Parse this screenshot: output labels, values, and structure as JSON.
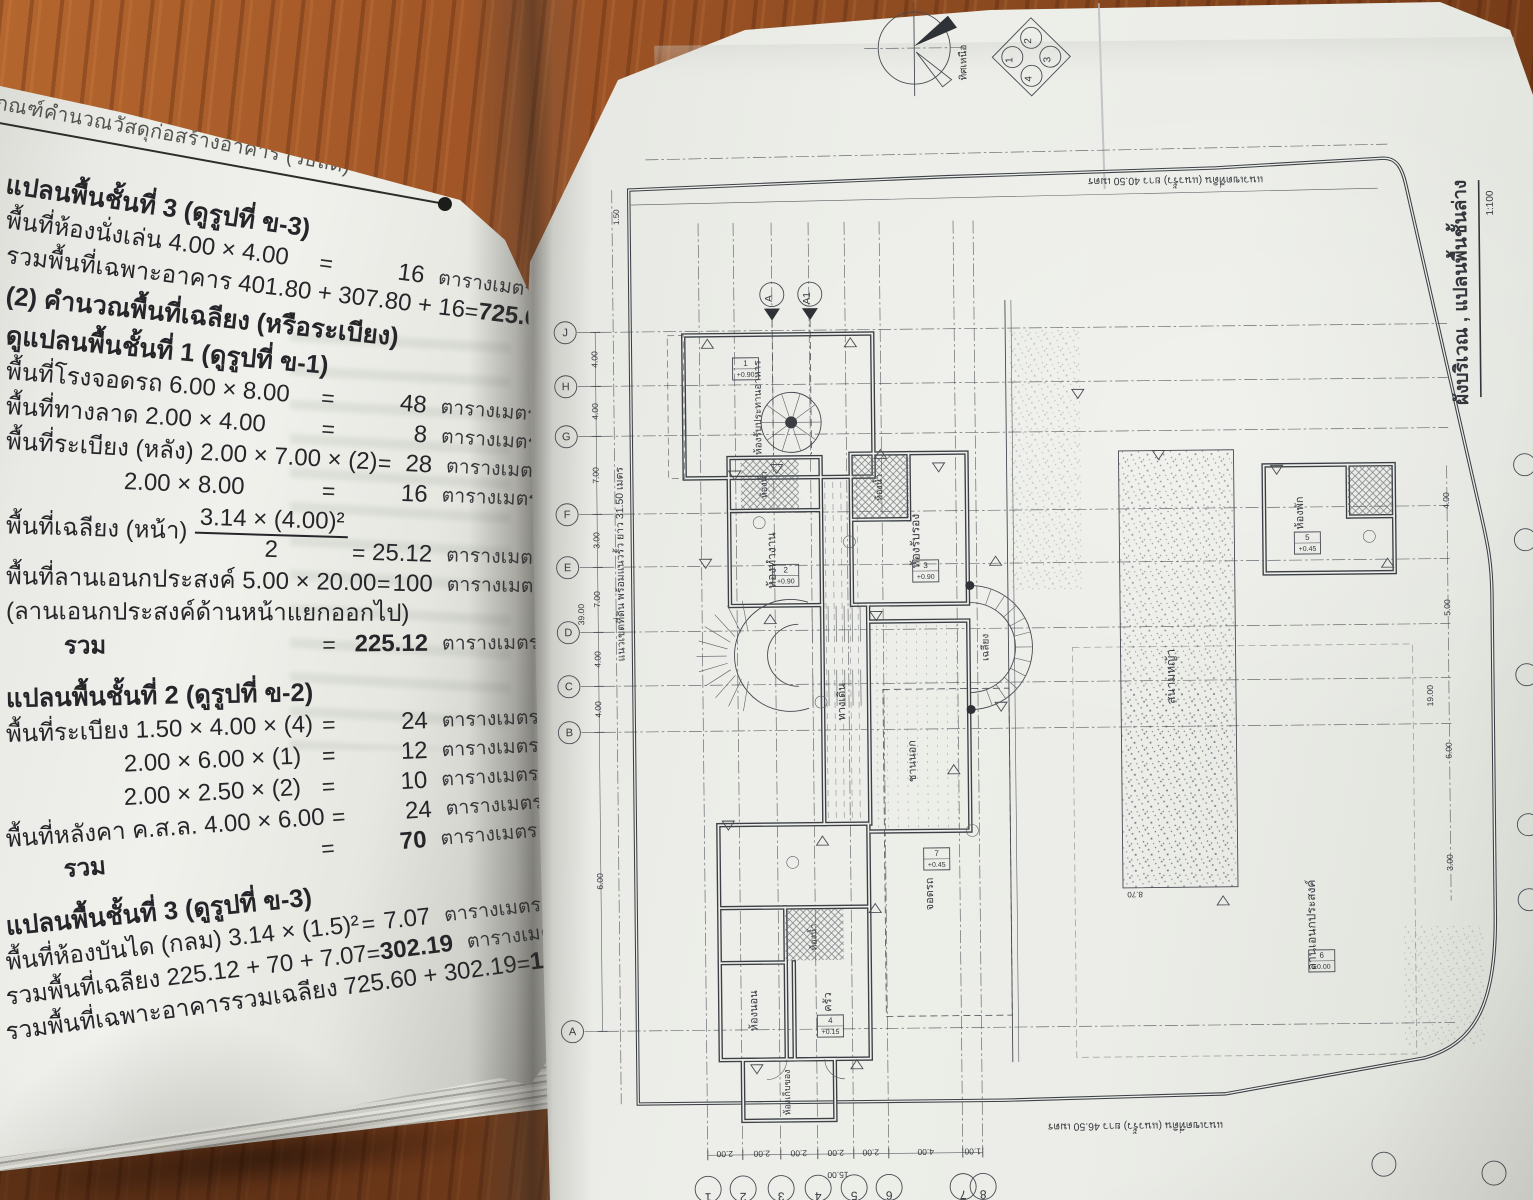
{
  "left_page": {
    "running_head": "เกณฑ์คำนวณวัสดุก่อสร้างอาคาร (วิธีลัด)",
    "equals": "=",
    "rows": [
      {
        "type": "h1",
        "label": "แปลนพื้นชั้นที่ 3 (ดูรูปที่ ข-3)"
      },
      {
        "label": "พื้นที่ห้องนั่งเล่น 4.00 × 4.00",
        "value": "16",
        "unit": "ตารางเมตร"
      },
      {
        "label": "รวมพื้นที่เฉพาะอาคาร 401.80 + 307.80 + 16",
        "value": "725.60",
        "unit": "ตารางเมตร",
        "bold_value": true
      },
      {
        "type": "h1",
        "label": "(2) คำนวณพื้นที่เฉลียง (หรือระเบียง)"
      },
      {
        "type": "h1",
        "label": "ดูแปลนพื้นชั้นที่ 1 (ดูรูปที่ ข-1)"
      },
      {
        "label": "พื้นที่โรงจอดรถ 6.00 × 8.00",
        "value": "48",
        "unit": "ตารางเมตร"
      },
      {
        "label": "พื้นที่ทางลาด 2.00 × 4.00",
        "value": "8",
        "unit": "ตารางเมตร"
      },
      {
        "label": "พื้นที่ระเบียง (หลัง) 2.00 × 7.00 × (2)",
        "value": "28",
        "unit": "ตารางเมตร"
      },
      {
        "label": "2.00 × 8.00",
        "indent": 2,
        "value": "16",
        "unit": "ตารางเมตร"
      },
      {
        "type": "frac",
        "label": "พื้นที่เฉลียง (หน้า)",
        "num": "3.14 × (4.00)²",
        "den": "2",
        "value": "25.12",
        "unit": "ตารางเมตร"
      },
      {
        "label": "พื้นที่ลานเอนกประสงค์  5.00 × 20.00",
        "value": "100",
        "unit": "ตารางเมตร"
      },
      {
        "label": "(ลานเอนกประสงค์ด้านหน้าแยกออกไป)"
      },
      {
        "label": "รวม",
        "indent": 1,
        "value": "225.12",
        "unit": "ตารางเมตร",
        "bold_value": true
      },
      {
        "type": "h1",
        "gap": true,
        "label": "แปลนพื้นชั้นที่ 2  (ดูรูปที่ ข-2)"
      },
      {
        "label": "พื้นที่ระเบียง  1.50 × 4.00 × (4)",
        "value": "24",
        "unit": "ตารางเมตร"
      },
      {
        "label": "2.00 × 6.00 × (1)",
        "indent": 2,
        "value": "12",
        "unit": "ตารางเมตร"
      },
      {
        "label": "2.00 × 2.50 × (2)",
        "indent": 2,
        "value": "10",
        "unit": "ตารางเมตร"
      },
      {
        "label": "พื้นที่หลังคา ค.ส.ล. 4.00 × 6.00",
        "value": "24",
        "unit": "ตารางเมตร"
      },
      {
        "label": "รวม",
        "indent": 1,
        "value": "70",
        "unit": "ตารางเมตร",
        "bold_value": true
      },
      {
        "type": "h1",
        "gap": true,
        "label": "แปลนพื้นชั้นที่ 3  (ดูรูปที่ ข-3)"
      },
      {
        "label": "พื้นที่ห้องบันได (กลม)  3.14 × (1.5)²",
        "value": "7.07",
        "unit": "ตารางเมตร"
      },
      {
        "label": "รวมพื้นที่เฉลียง  225.12 + 70 + 7.07",
        "value": "302.19",
        "unit": "ตารางเมตร",
        "bold_value": true
      },
      {
        "label": "รวมพื้นที่เฉพาะอาคารรวมเฉลียง 725.60 + 302.19",
        "value": "1,027.79",
        "unit": "ตารางเมตร",
        "bold_value": true
      }
    ]
  },
  "right_page": {
    "title": "ผังบริเวณ , แปลนพื้นชั้นล่าง",
    "scale": "1:100",
    "compass_label": "ทิศเหนือ",
    "boundary_top": "แนวเขตที่ดิน (แนวรั้ว) ยาว 40.50 เมตร",
    "boundary_bottom": "แนวเขตที่ดิน (แนวรั้ว) ยาว 46.50 เมตร",
    "boundary_left": "แนวเขตที่ดิน พร้อมแนวรั้ว ยาว 31.50 เมตร",
    "keyplan_numbers": [
      {
        "t": "1",
        "x": 498,
        "y": 57
      },
      {
        "t": "2",
        "x": 517,
        "y": 38
      },
      {
        "t": "3",
        "x": 536,
        "y": 57
      },
      {
        "t": "4",
        "x": 517,
        "y": 76
      }
    ],
    "section_markers": [
      {
        "t": "A",
        "x": 255,
        "y": 292
      },
      {
        "t": "A1",
        "x": 293,
        "y": 292
      }
    ],
    "grid_letters": [
      {
        "t": "J",
        "y": 328
      },
      {
        "t": "H",
        "y": 382
      },
      {
        "t": "G",
        "y": 432
      },
      {
        "t": "F",
        "y": 510
      },
      {
        "t": "E",
        "y": 563
      },
      {
        "t": "D",
        "y": 628
      },
      {
        "t": "C",
        "y": 682
      },
      {
        "t": "B",
        "y": 728
      },
      {
        "t": "A",
        "y": 1027
      }
    ],
    "grid_numbers": [
      {
        "t": "1",
        "x": 182
      },
      {
        "t": "2",
        "x": 217
      },
      {
        "t": "3",
        "x": 255
      },
      {
        "t": "4",
        "x": 292
      },
      {
        "t": "5",
        "x": 328
      },
      {
        "t": "6",
        "x": 363
      },
      {
        "t": "7",
        "x": 437
      },
      {
        "t": "8",
        "x": 457
      }
    ],
    "dims_left": [
      {
        "t": "4.00",
        "y": 355
      },
      {
        "t": "4.00",
        "y": 407
      },
      {
        "t": "7.00",
        "y": 471
      },
      {
        "t": "3.00",
        "y": 536
      },
      {
        "t": "7.00",
        "y": 595
      },
      {
        "t": "4.00",
        "y": 655
      },
      {
        "t": "4.00",
        "y": 705
      },
      {
        "t": "6.00",
        "y": 877
      }
    ],
    "dims_left_total": "39.00",
    "dims_bottom": [
      {
        "t": "2.00",
        "x": 199
      },
      {
        "t": "2.00",
        "x": 236
      },
      {
        "t": "2.00",
        "x": 273
      },
      {
        "t": "2.00",
        "x": 310
      },
      {
        "t": "2.00",
        "x": 345
      },
      {
        "t": "4.00",
        "x": 400
      },
      {
        "t": "1.00",
        "x": 447
      }
    ],
    "dims_bottom_total": "15.00",
    "dims_right": [
      {
        "t": "4.00",
        "y": 505
      },
      {
        "t": "5.00",
        "y": 612
      },
      {
        "t": "6.00",
        "y": 755
      },
      {
        "t": "3.00",
        "y": 867
      }
    ],
    "dims_right_total": "19.00",
    "misc_dims": [
      {
        "t": "1.50",
        "x": 103,
        "y": 213,
        "r": -90
      },
      {
        "t": "8.70",
        "x": 612,
        "y": 893,
        "r": 180
      }
    ],
    "room_labels": [
      {
        "t": "ห้องรับประทานอาหาร",
        "x": 243,
        "y": 405,
        "s": 10
      },
      {
        "t": "ห้องทำงาน",
        "x": 256,
        "y": 558,
        "s": 12
      },
      {
        "t": "ห้องรับรอง",
        "x": 400,
        "y": 540,
        "s": 12
      },
      {
        "t": "ห้องน้ำ",
        "x": 248,
        "y": 482,
        "s": 9
      },
      {
        "t": "ห้องน้ำ",
        "x": 363,
        "y": 486,
        "s": 9
      },
      {
        "t": "ทางเดิน",
        "x": 324,
        "y": 700,
        "s": 11
      },
      {
        "t": "ชานนอก",
        "x": 394,
        "y": 760,
        "s": 11
      },
      {
        "t": "เฉลียง",
        "x": 468,
        "y": 647,
        "s": 10
      },
      {
        "t": "จอดรถ",
        "x": 410,
        "y": 893,
        "s": 11
      },
      {
        "t": "ห้องน้ำ",
        "x": 293,
        "y": 935,
        "s": 9
      },
      {
        "t": "ห้องนอน",
        "x": 233,
        "y": 1008,
        "s": 11
      },
      {
        "t": "ครัว",
        "x": 307,
        "y": 1000,
        "s": 11
      },
      {
        "t": "ห้องเก็บของ",
        "x": 265,
        "y": 1090,
        "s": 9
      },
      {
        "t": "สนามหญ้า",
        "x": 654,
        "y": 678,
        "s": 12
      },
      {
        "t": "ห้องพัก",
        "x": 784,
        "y": 516,
        "s": 11
      },
      {
        "t": "ลานเอนกประสงค์",
        "x": 792,
        "y": 928,
        "s": 12
      }
    ],
    "level_boxes": [
      {
        "x": 228,
        "y": 366,
        "no": "1",
        "lv": "+0.90"
      },
      {
        "x": 266,
        "y": 573,
        "no": "2",
        "lv": "+0.90"
      },
      {
        "x": 406,
        "y": 570,
        "no": "3",
        "lv": "+0.90"
      },
      {
        "x": 306,
        "y": 1024,
        "no": "4",
        "lv": "+0.15"
      },
      {
        "x": 788,
        "y": 546,
        "no": "5",
        "lv": "+0.45"
      },
      {
        "x": 414,
        "y": 858,
        "no": "7",
        "lv": "+0.45"
      },
      {
        "x": 798,
        "y": 964,
        "no": "6",
        "lv": "±0.00"
      }
    ]
  }
}
